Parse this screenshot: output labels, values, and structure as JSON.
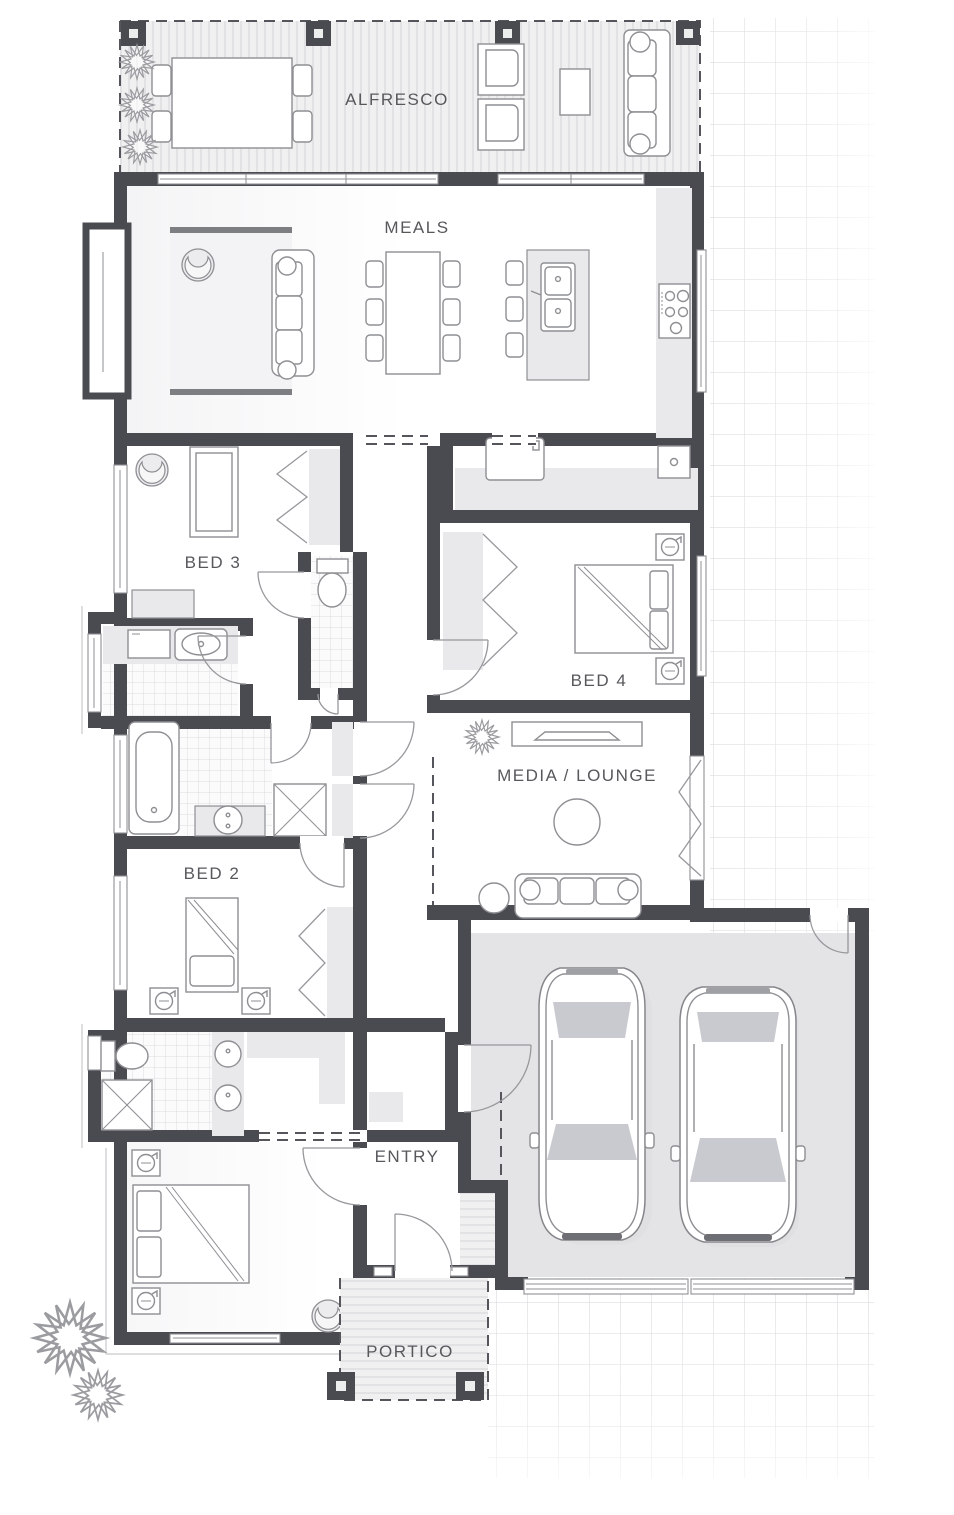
{
  "plan": {
    "rooms": [
      {
        "id": "alfresco",
        "label": "ALFRESCO"
      },
      {
        "id": "meals",
        "label": "MEALS"
      },
      {
        "id": "bed3",
        "label": "BED 3"
      },
      {
        "id": "bed4",
        "label": "BED 4"
      },
      {
        "id": "media",
        "label": "MEDIA / LOUNGE"
      },
      {
        "id": "bed2",
        "label": "BED 2"
      },
      {
        "id": "entry",
        "label": "ENTRY"
      },
      {
        "id": "portico",
        "label": "PORTICO"
      }
    ],
    "colors": {
      "wall": "#4a4b51",
      "floor": "#ffffff",
      "fixture_fill": "#e9e9eb",
      "furniture_line": "#8e8f93",
      "deck_fill": "#f0f0f1",
      "deck_stripe": "#e2e2e4",
      "tile_line": "#dcdcdf",
      "grid_line": "#d6d6da",
      "garage_floor": "#e4e4e6",
      "label_text": "#56585c",
      "dash_line": "#55565b",
      "rug_bar": "#7d7e82"
    }
  }
}
